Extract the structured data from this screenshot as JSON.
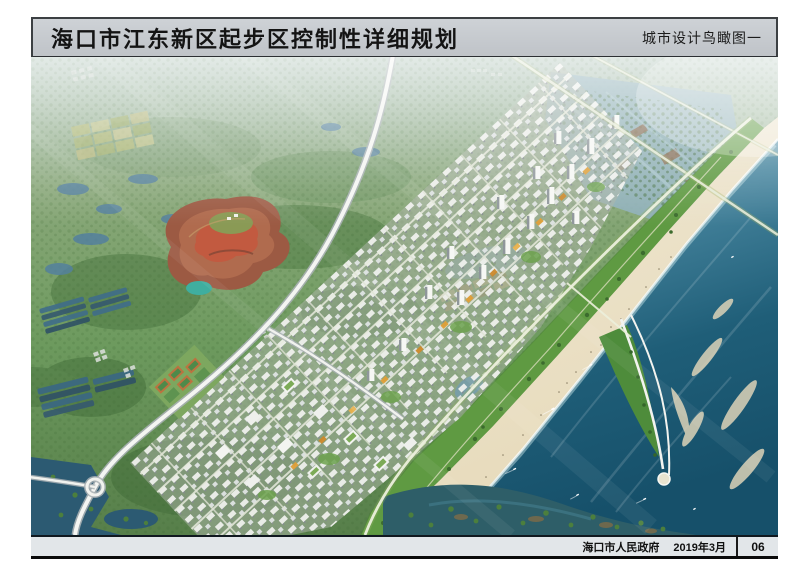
{
  "header": {
    "title": "海口市江东新区起步区控制性详细规划",
    "view_label": "城市设计鸟瞰图一"
  },
  "footer": {
    "authority": "海口市人民政府",
    "date": "2019年3月",
    "page_number": "06"
  },
  "aerial_view": {
    "description": "海口市江东新区起步区城市设计鸟瞰效果图：滨海新城沿海岸线斜向展开，右侧为大海、沙滩与帆形游艇码头，中部为高层建筑群与金色发展轴，左侧为田园、鱼塘与红色山体公园，上部为河口湿地，左下为高速公路互通与红树林水域",
    "features": [
      "sea",
      "beach",
      "coastal-park",
      "sail-pier",
      "city-towers",
      "golden-axis",
      "red-hill-park",
      "farmland",
      "fish-ponds",
      "estuary-wetland",
      "mangrove-wetland",
      "highway",
      "interchange",
      "roundabout",
      "sports-courts",
      "sandbars",
      "boats",
      "haze"
    ],
    "palette": {
      "sea_deep": "#1d5a74",
      "sea_light": "#8fc2cf",
      "beach_sand": "#eee4c8",
      "forest_green": "#5d8a4f",
      "building_white": "#f4f5f2",
      "accent_orange": "#dd9a33",
      "pond_blue": "#4f7f9e",
      "red_hill": "#a14e44",
      "header_bar_gray": "#c6cace",
      "footer_gray": "#e2e6e9"
    }
  }
}
